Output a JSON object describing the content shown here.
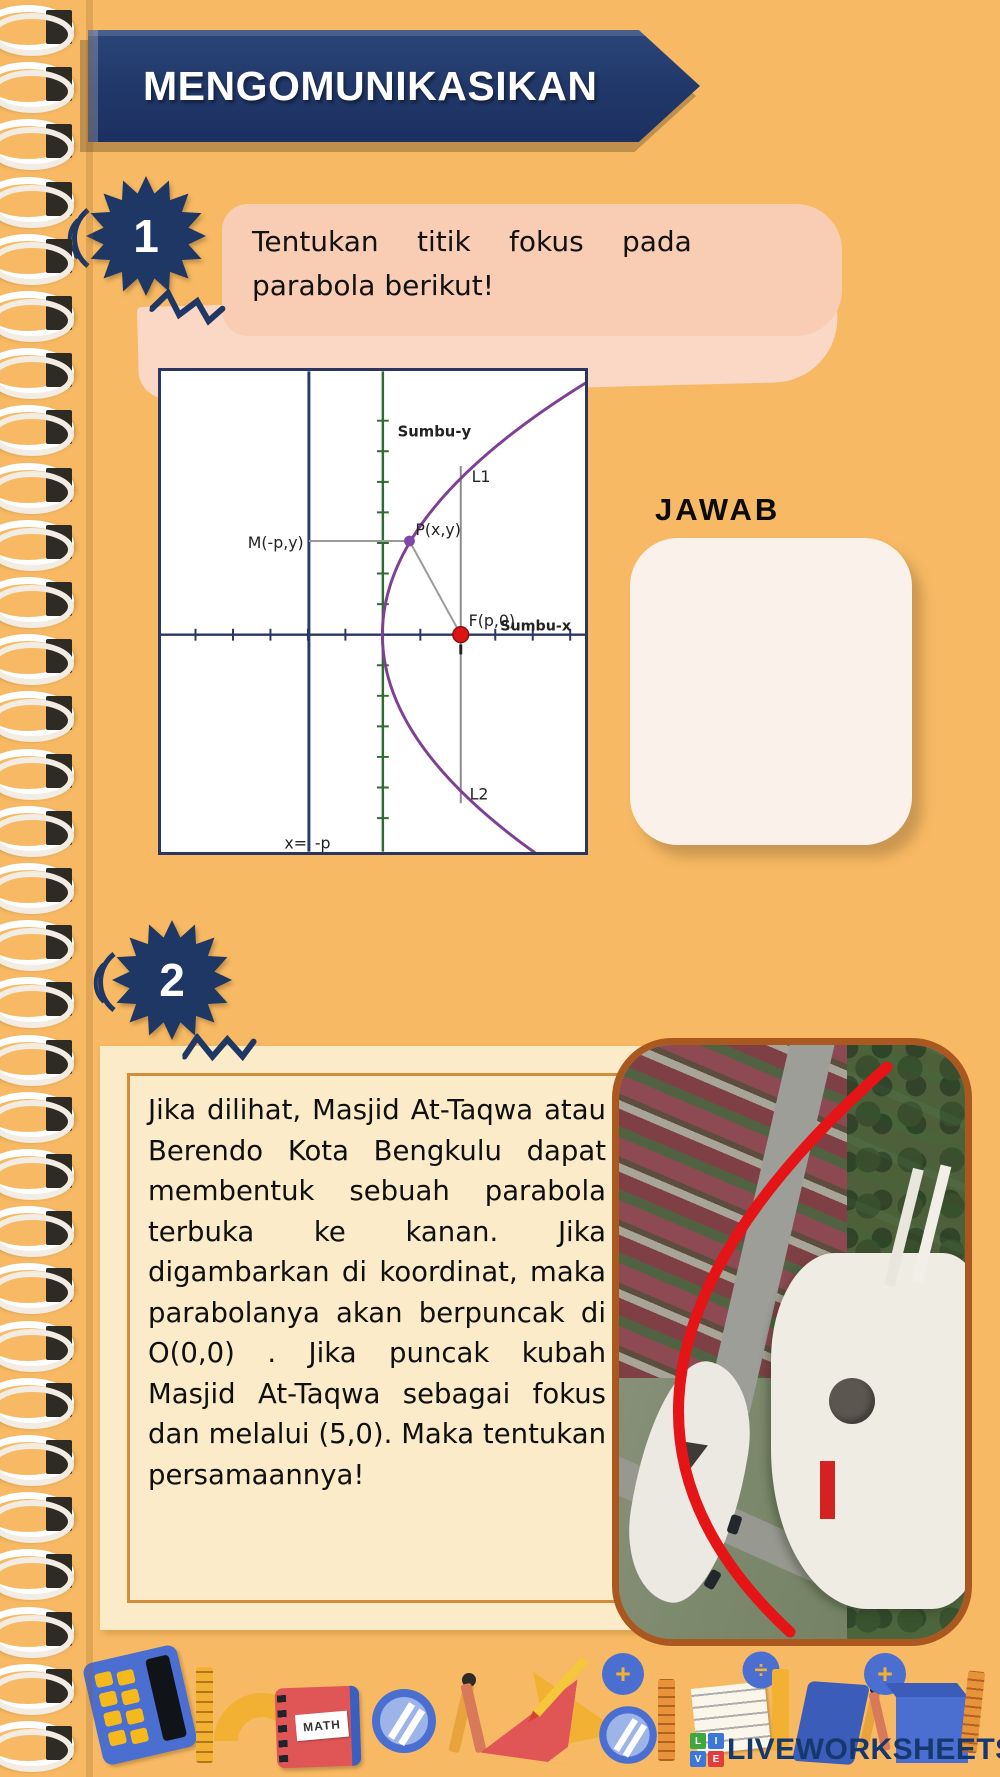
{
  "banner": {
    "title": "MENGOMUNIKASIKAN",
    "color": "#22396B"
  },
  "q1": {
    "number": "1",
    "line1": "Tentukan titik fokus pada",
    "line2": "parabola berikut!"
  },
  "diagram": {
    "sumbu_y": "Sumbu-y",
    "sumbu_x": "Sumbu-x",
    "l1": "L1",
    "l2": "L2",
    "p_label": "P(x,y)",
    "m_label": "M(-p,y)",
    "f_label": "F(p,0)",
    "directrix_x": "x=",
    "directrix_p": "-p",
    "colors": {
      "parabola": "#7E3F94",
      "focus_dot": "#DD1414",
      "point_dot": "#8246A8",
      "y_axis": "#2F6B33",
      "x_axis": "#2A3660",
      "directrix": "#2B3A6E"
    }
  },
  "jawab": {
    "label": "JAWAB"
  },
  "q2": {
    "number": "2",
    "text": "Jika dilihat, Masjid At-Taqwa atau Berendo Kota Bengkulu dapat membentuk sebuah parabola terbuka ke kanan. Jika digambarkan di koordinat, maka parabolanya akan berpuncak di O(0,0) . Jika puncak kubah Masjid At-Taqwa sebagai fokus dan melalui (5,0). Maka tentukan persamaannya!"
  },
  "photo": {
    "red_curve_color": "#E41417",
    "border_color": "#AA5820"
  },
  "decor": {
    "math_label": "MATH"
  },
  "logo": {
    "text": "LIVEWORKSHEETS",
    "text_color": "#16386E",
    "blocks": [
      {
        "letter": "L",
        "color": "#3FA73F"
      },
      {
        "letter": "I",
        "color": "#3B76D8"
      },
      {
        "letter": "V",
        "color": "#3B76D8"
      },
      {
        "letter": "E",
        "color": "#E23C3C"
      }
    ]
  },
  "page": {
    "background": "#F7B963",
    "accent_navy": "#1E3765",
    "peach": "#F9CDB4",
    "cream": "#FBEBC9"
  }
}
